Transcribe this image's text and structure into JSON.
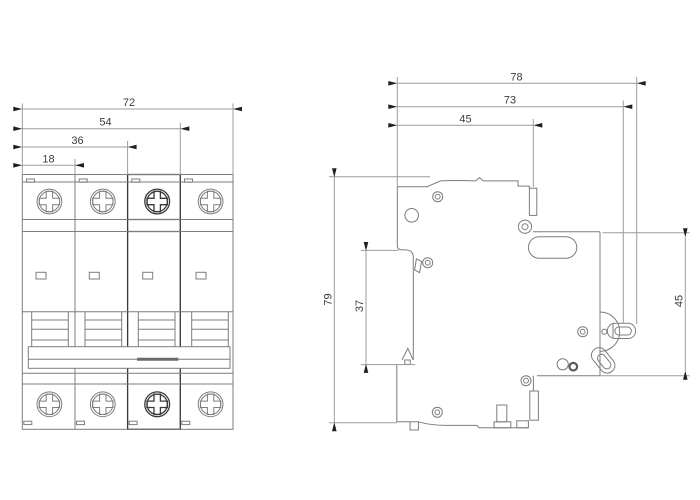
{
  "dimensions": {
    "front_overall_width": "72",
    "front_width_3_poles": "54",
    "front_width_2_poles": "36",
    "front_width_1_pole": "18",
    "side_overall_depth": "78",
    "side_depth_to_toggle": "73",
    "side_depth_to_front_step": "45",
    "side_overall_height": "79",
    "side_rail_recess_height": "37",
    "side_front_face_height": "45"
  },
  "colors": {
    "background": "#ffffff",
    "line": "#7d7d7d",
    "dim-line": "#9c9c9c",
    "accent-line": "#3a3a3a",
    "text": "#3c3c3c",
    "arrow": "#1f1f1f"
  }
}
